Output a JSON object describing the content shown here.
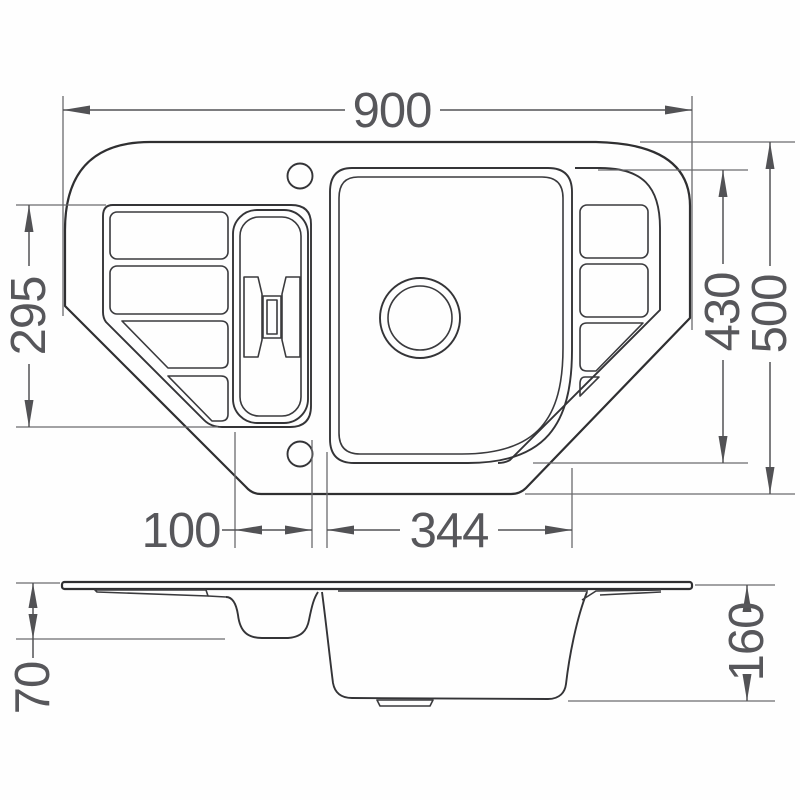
{
  "drawing": {
    "title": "Corner kitchen sink - dimensioned technical drawing, plan view and section view",
    "views": {
      "plan": "top view of 1.5-bowl corner sink with drainer ribs",
      "side": "front section view"
    },
    "dims": {
      "overall_width": "900",
      "left_drainer_depth": "295",
      "bowl_zone_height": "430",
      "overall_depth": "500",
      "half_bowl_width": "100",
      "main_bowl_width": "344",
      "half_bowl_depth": "70",
      "main_bowl_depth": "160"
    },
    "colors": {
      "background": "#fefefe",
      "drawing_lines": "#2f2f31",
      "dimension_lines": "#525255",
      "dimension_text": "#57575b"
    }
  }
}
